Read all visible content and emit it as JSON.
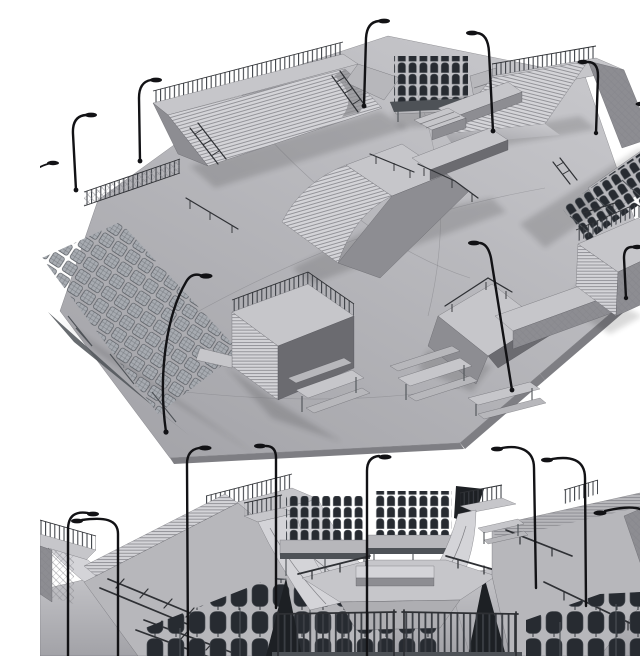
{
  "scene": {
    "title": "Skatepark 3D model — greyscale clay render, two views on white background",
    "render_style": "untextured grey 3D render with wireframe-like edge lines",
    "views": [
      {
        "id": "aerial",
        "label": "Aerial three-quarter view of an octagonal skatepark plaza with ramps, rails, grandstands and street lamps"
      },
      {
        "id": "front",
        "label": "Front ground-level elevation view of the same skatepark, cropped at the bottom edge"
      }
    ],
    "objects": [
      {
        "name": "octagonal-concrete-slab",
        "count": 1
      },
      {
        "name": "quarter-pipe-ramp",
        "count": 7
      },
      {
        "name": "bank-ramp",
        "count": 4
      },
      {
        "name": "funbox-pyramid",
        "count": 2
      },
      {
        "name": "grind-ledge",
        "count": 4
      },
      {
        "name": "handrail",
        "count": 8
      },
      {
        "name": "ladder-rail",
        "count": 6
      },
      {
        "name": "grandstand-bucket-seats",
        "count": 3
      },
      {
        "name": "bleacher-seating",
        "count": 4
      },
      {
        "name": "picnic-table",
        "count": 4
      },
      {
        "name": "street-lamp",
        "count": 18
      },
      {
        "name": "safety-railing-fence",
        "count": 12
      },
      {
        "name": "barrier-fence",
        "count": 2
      }
    ]
  },
  "palette": {
    "background": "#ffffff",
    "slabLight": "#c8c8cc",
    "slabDark": "#a2a2a7",
    "rampTop": "#c6c6ca",
    "rampFace": "#d4d4d8",
    "sideMid": "#8d8d92",
    "sideDark": "#6b6b70",
    "edgeDark": "#7e7e83",
    "line": "#6e6e73",
    "stripe": "#84848a",
    "metal": "#2e3034",
    "lampBlack": "#121215",
    "fenceBar": "#3b3e44",
    "seatDark": "#272b31",
    "seatLight": "#a7abb1",
    "frameDark": "#4e5257",
    "shadowColor": "#1a1a1e"
  }
}
